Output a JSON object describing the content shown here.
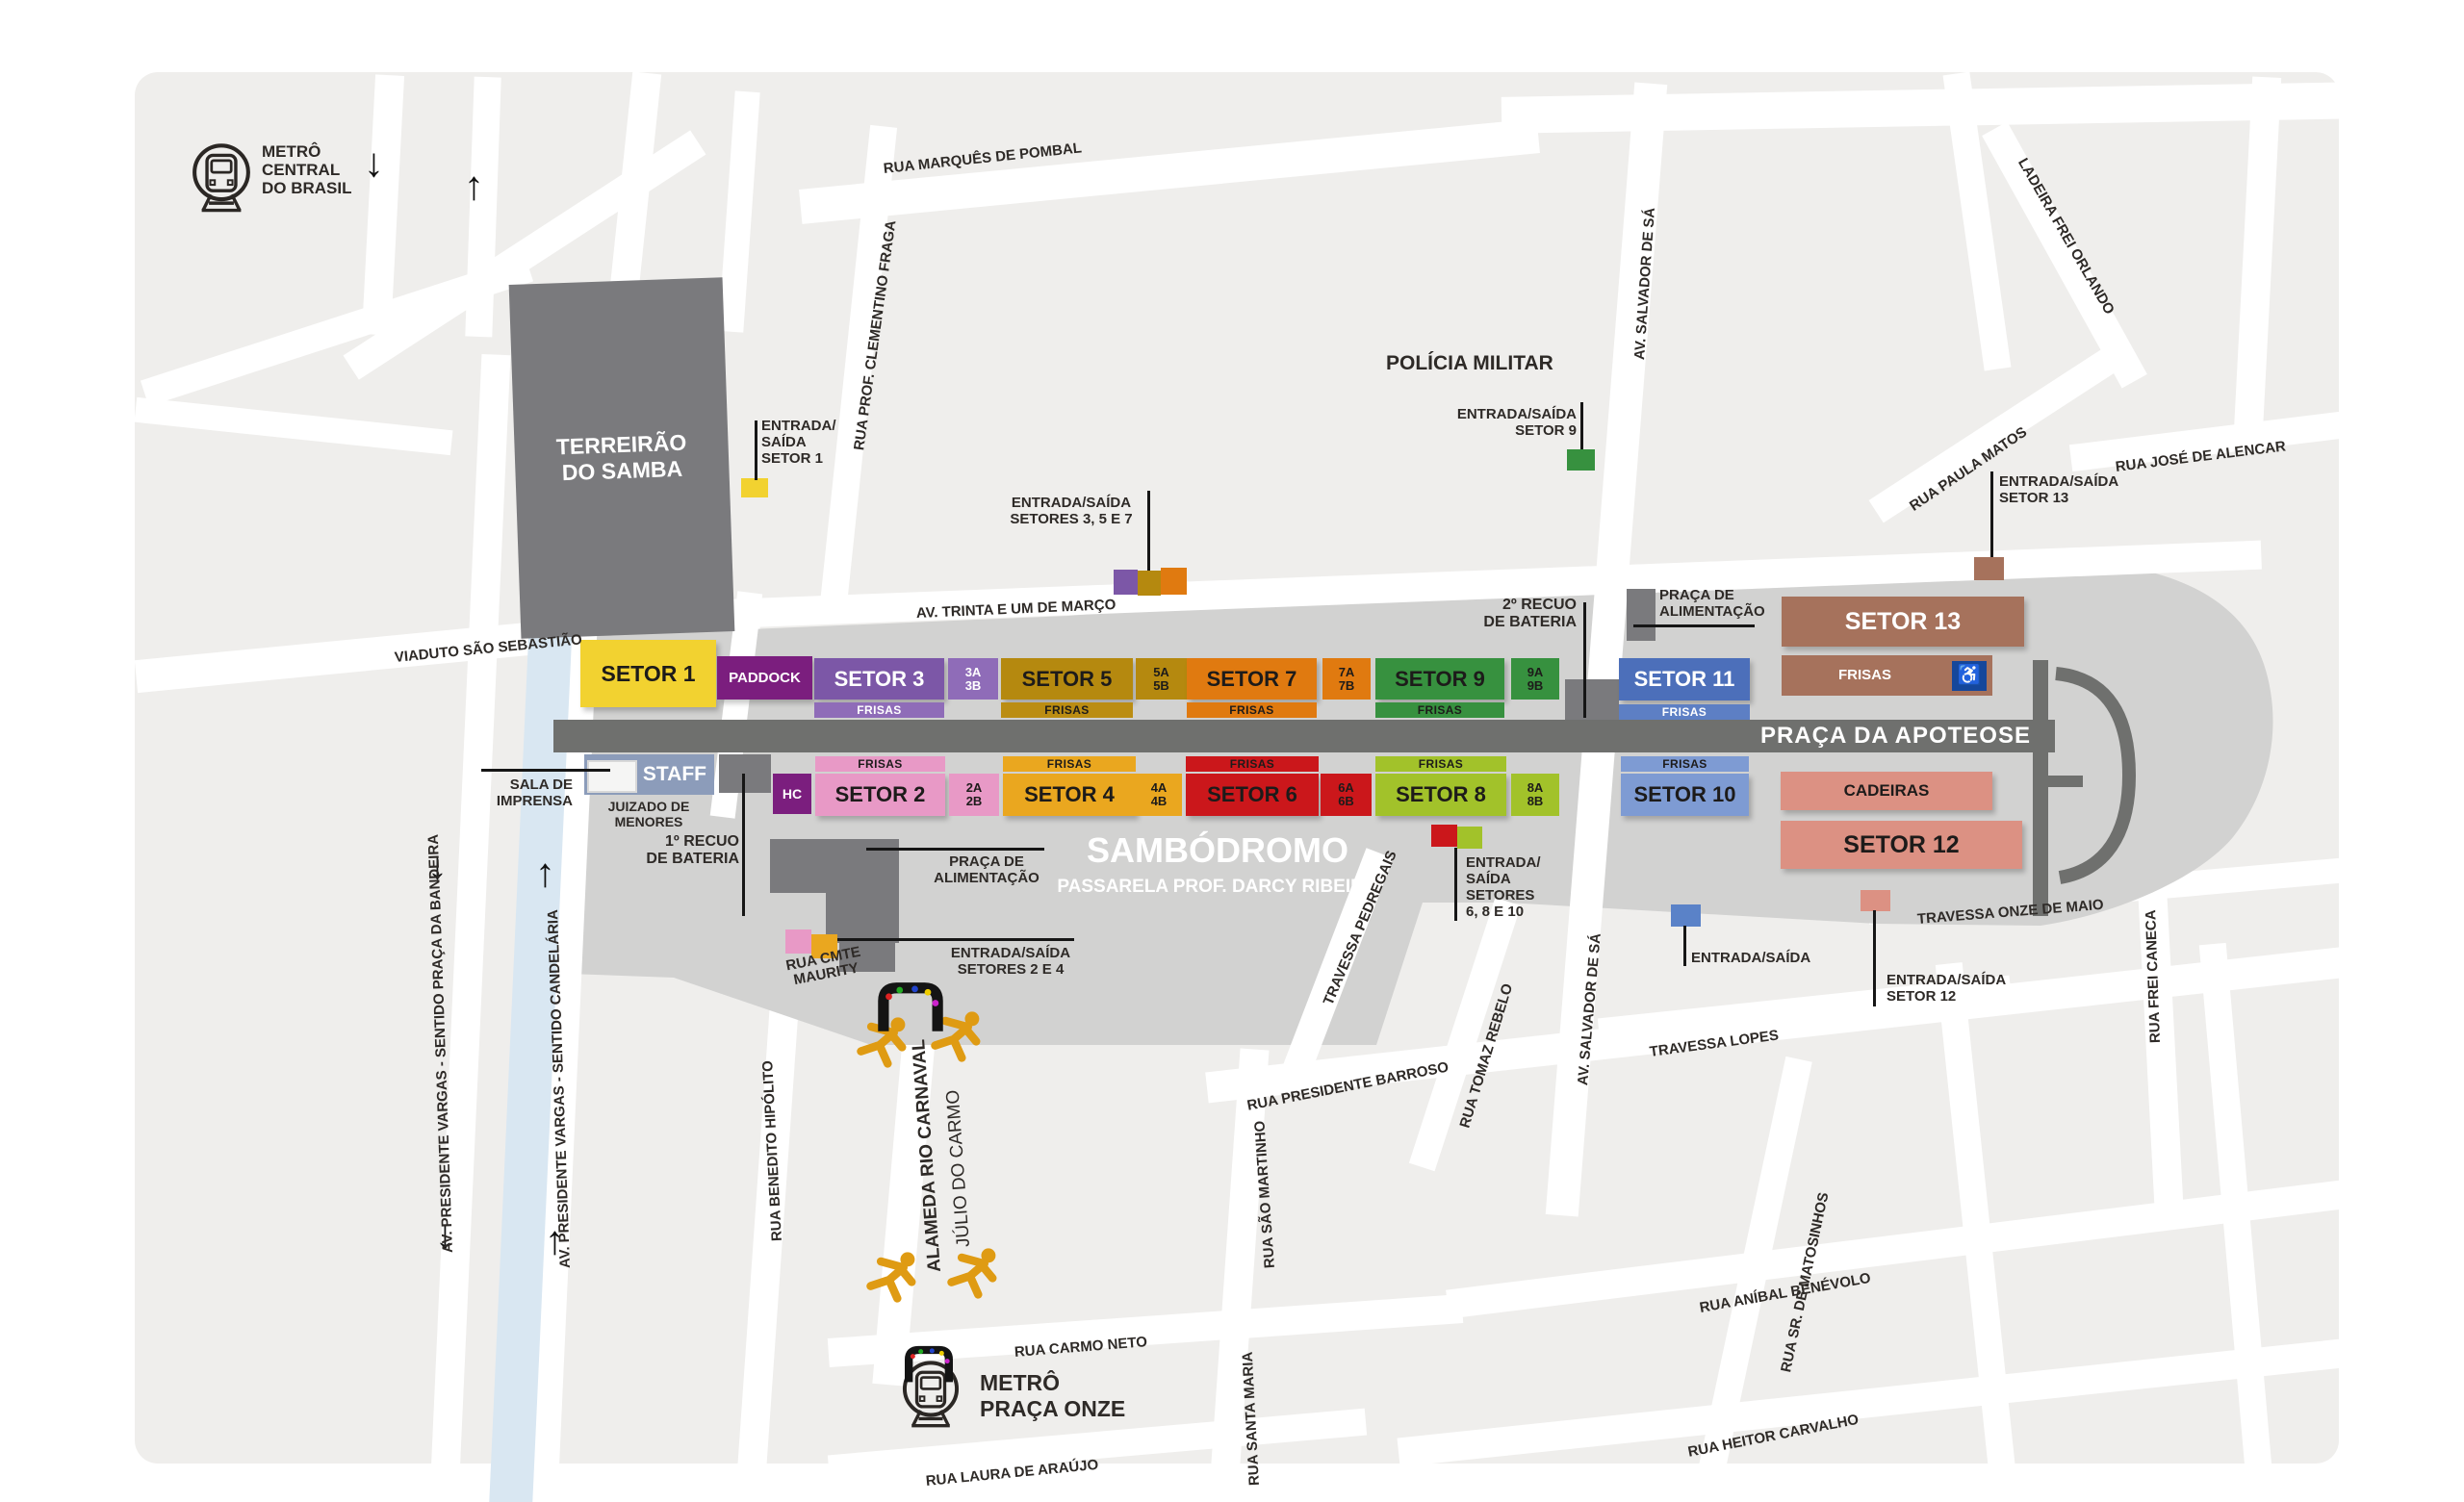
{
  "map": {
    "stations": {
      "central": {
        "l1": "METRÔ",
        "l2": "CENTRAL",
        "l3": "DO BRASIL"
      },
      "praca_onze": {
        "l1": "METRÔ",
        "l2": "PRAÇA ONZE"
      }
    },
    "landmarks": {
      "terreirao_l1": "TERREIRÃO",
      "terreirao_l2": "DO SAMBA",
      "policia_militar": "POLÍCIA MILITAR",
      "sambodromo": "SAMBÓDROMO",
      "passarela": "PASSARELA PROF. DARCY RIBEIRO",
      "praca_apoteose": "PRAÇA DA APOTEOSE",
      "sala_l1": "SALA DE",
      "sala_l2": "IMPRENSA",
      "juizado_l1": "JUIZADO DE",
      "juizado_l2": "MENORES",
      "staff": "STAFF",
      "hc": "HC",
      "paddock": "PADDOCK",
      "recuo1": "1º RECUO",
      "recuo2": "2º RECUO",
      "recuo_l2": "DE BATERIA",
      "alimentacao_l1": "PRAÇA DE",
      "alimentacao_l2": "ALIMENTAÇÃO",
      "cadeiras": "CADEIRAS"
    },
    "sectors": {
      "s1": "SETOR 1",
      "s2": "SETOR 2",
      "s3": "SETOR 3",
      "s4": "SETOR 4",
      "s5": "SETOR 5",
      "s6": "SETOR 6",
      "s7": "SETOR 7",
      "s8": "SETOR 8",
      "s9": "SETOR 9",
      "s10": "SETOR 10",
      "s11": "SETOR 11",
      "s12": "SETOR 12",
      "s13": "SETOR 13",
      "frisas": "FRISAS",
      "sub2a": "2A",
      "sub2b": "2B",
      "sub3a": "3A",
      "sub3b": "3B",
      "sub4a": "4A",
      "sub4b": "4B",
      "sub5a": "5A",
      "sub5b": "5B",
      "sub6a": "6A",
      "sub6b": "6B",
      "sub7a": "7A",
      "sub7b": "7B",
      "sub8a": "8A",
      "sub8b": "8B",
      "sub9a": "9A",
      "sub9b": "9B"
    },
    "entrances": {
      "e1_l1": "ENTRADA/",
      "e1_l2": "SAÍDA",
      "e1_l3": "SETOR 1",
      "e357_l1": "ENTRADA/SAÍDA",
      "e357_l2": "SETORES 3, 5 E 7",
      "e9_l1": "ENTRADA/SAÍDA",
      "e9_l2": "SETOR 9",
      "e13_l1": "ENTRADA/SAÍDA",
      "e13_l2": "SETOR 13",
      "e24_l1": "ENTRADA/SAÍDA",
      "e24_l2": "SETORES 2 E 4",
      "e6810_l1": "ENTRADA/",
      "e6810_l2": "SAÍDA",
      "e6810_l3": "SETORES",
      "e6810_l4": "6, 8 E 10",
      "egen": "ENTRADA/SAÍDA",
      "e12_l1": "ENTRADA/SAÍDA",
      "e12_l2": "SETOR 12"
    },
    "streets": {
      "marques_pombal": "RUA MARQUÊS DE POMBAL",
      "clementino_fraga": "RUA PROF. CLEMENTINO FRAGA",
      "viaduto_sebastiao": "VIADUTO SÃO SEBASTIÃO",
      "trinta_um_marco": "AV. TRINTA E UM DE MARÇO",
      "salvador_sa": "AV. SALVADOR DE SÁ",
      "ladeira_frei_orlando": "LADEIRA FREI ORLANDO",
      "paula_matos": "RUA PAULA MATOS",
      "jose_alencar": "RUA JOSÉ DE ALENCAR",
      "frei_caneca": "RUA FREI CANECA",
      "onze_maio": "TRAVESSA ONZE DE MAIO",
      "pedregais": "TRAVESSA PEDREGAIS",
      "tomaz_rebelo": "RUA TOMAZ REBELO",
      "pres_barroso": "RUA PRESIDENTE BARROSO",
      "lopes": "TRAVESSA LOPES",
      "matosinhos": "RUA SR. DE MATOSINHOS",
      "anibal_benevolo": "RUA ANÍBAL BENÉVOLO",
      "heitor_carvalho": "RUA HEITOR CARVALHO",
      "sao_martinho": "RUA SÃO MARTINHO",
      "santa_maria": "RUA SANTA MARIA",
      "carmo_neto": "RUA CARMO NETO",
      "laura_araujo": "RUA LAURA DE ARAÚJO",
      "benedito_hipolito": "RUA BENEDITO HIPÓLITO",
      "alameda_rio_carnaval": "ALAMEDA RIO CARNAVAL",
      "julio_carmo": "JÚLIO DO CARMO",
      "vargas_bandeira": "AV. PRESIDENTE VARGAS - SENTIDO PRAÇA DA BANDEIRA",
      "vargas_candelaria": "AV. PRESIDENTE VARGAS - SENTIDO CANDELÁRIA",
      "cmte_maurity_l1": "RUA CMTE",
      "cmte_maurity_l2": "MAURITY"
    },
    "icons": {
      "wheelchair": "♿",
      "arrow_down": "↓",
      "arrow_up": "↑"
    },
    "colors": {
      "setor1": "#F2D230",
      "paddock": "#7B1E7E",
      "setor3": "#7C57A7",
      "setor3_light": "#8F6CB8",
      "setor5": "#B5890F",
      "setor7": "#E07A10",
      "setor9": "#37913F",
      "setor11": "#4C6FBA",
      "setor13": "#A6725C",
      "setor2": "#E899C6",
      "setor4": "#EAA71F",
      "setor6": "#CB171B",
      "setor8": "#A2C22A",
      "setor10": "#7E9BD3",
      "setor12": "#DC9183",
      "staff": "#8C9CBA",
      "entrance_blue": "#5A82C8",
      "wheelchair_bg": "#15479B",
      "canal": "#D9E7F2",
      "band": "#D2D2D1",
      "runway": "#6F706E",
      "dark_block": "#7A7A7D",
      "base_block": "#EFEEEC"
    }
  }
}
